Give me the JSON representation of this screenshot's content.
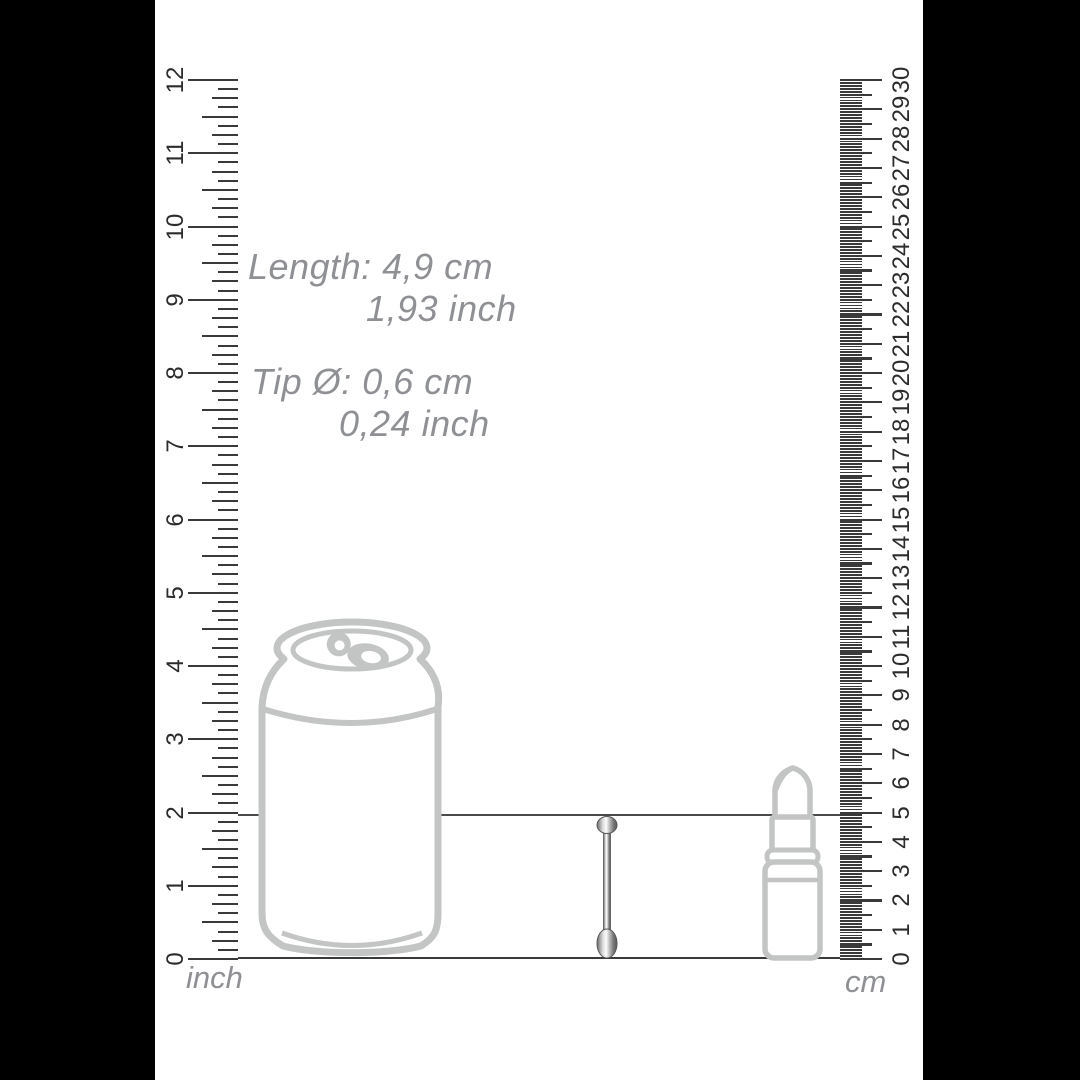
{
  "annotations": {
    "length": {
      "line1": "Length: 4,9 cm",
      "line2": "1,93 inch"
    },
    "tip": {
      "line1": "Tip Ø: 0,6 cm",
      "line2": "0,24 inch"
    }
  },
  "rulers": {
    "inch": {
      "unit": "inch",
      "numbers": [
        "0",
        "1",
        "2",
        "3",
        "4",
        "5",
        "6",
        "7",
        "8",
        "9",
        "10",
        "11",
        "12"
      ]
    },
    "cm": {
      "unit": "cm",
      "numbers": [
        "0",
        "1",
        "2",
        "3",
        "4",
        "5",
        "6",
        "7",
        "8",
        "9",
        "10",
        "11",
        "12",
        "13",
        "14",
        "15",
        "16",
        "17",
        "18",
        "19",
        "20",
        "21",
        "22",
        "23",
        "24",
        "25",
        "26",
        "27",
        "28",
        "29",
        "30"
      ]
    }
  },
  "objects": {
    "can": "soda-can-outline",
    "lipstick": "lipstick-outline",
    "product": "metal-rod-product"
  },
  "colors": {
    "ink": "#3a3a3a",
    "ruler_number": "#2c2c2c",
    "annotation_gray": "#8e9094",
    "outline_gray": "#c3c4c4",
    "background": "#ffffff",
    "letterbox": "#000000"
  }
}
